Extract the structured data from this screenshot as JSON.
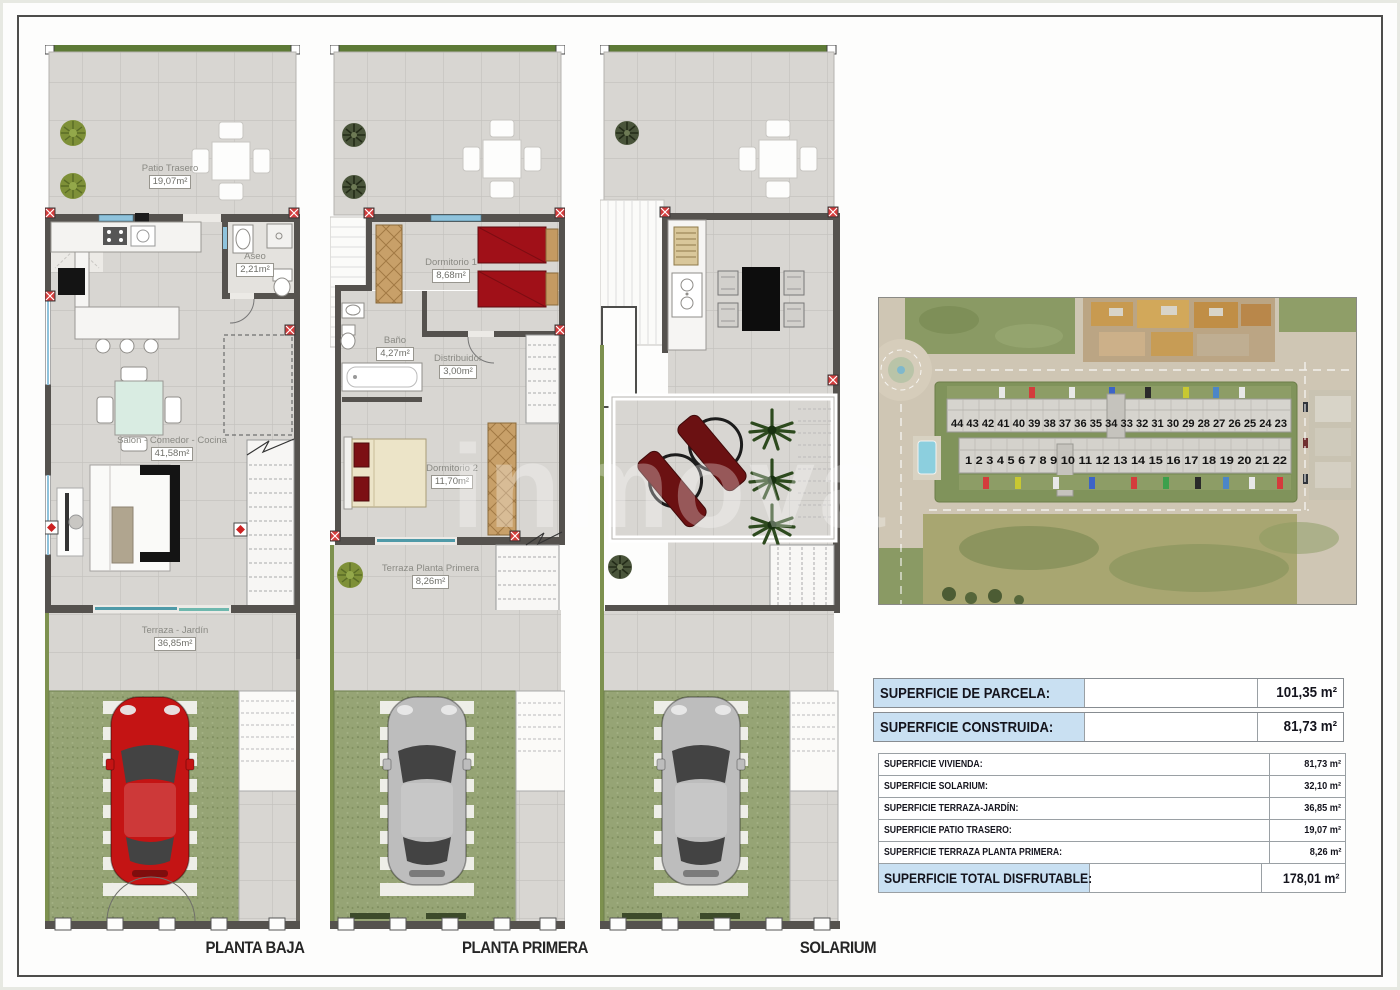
{
  "watermark": "inmova",
  "floors": {
    "planta_baja": {
      "caption": "PLANTA BAJA",
      "rooms": {
        "patio_trasero": {
          "name": "Patio Trasero",
          "area": "19,07m²"
        },
        "aseo": {
          "name": "Aseo",
          "area": "2,21m²"
        },
        "salon": {
          "name": "Salón - Comedor - Cocina",
          "area": "41,58m²"
        },
        "terraza_jardin": {
          "name": "Terraza - Jardín",
          "area": "36,85m²"
        }
      }
    },
    "planta_primera": {
      "caption": "PLANTA PRIMERA",
      "rooms": {
        "dormitorio_1": {
          "name": "Dormitorio 1",
          "area": "8,68m²"
        },
        "bano": {
          "name": "Baño",
          "area": "4,27m²"
        },
        "distribuidor": {
          "name": "Distribuidor",
          "area": "3,00m²"
        },
        "dormitorio_2": {
          "name": "Dormitorio 2",
          "area": "11,70m²"
        },
        "terraza_planta_primera": {
          "name": "Terraza Planta Primera",
          "area": "8,26m²"
        }
      }
    },
    "solarium": {
      "caption": "SOLARIUM"
    }
  },
  "aerial_plot": {
    "back_row_numbers": "44 43 42 41 40 39 38 37 36 35 34 33 32 31 30 29 28 27 26 25 24 23",
    "front_row_numbers": "1 2 3 4 5 6 7 8 9 10 11 12 13 14 15 16 17 18 19 20 21 22"
  },
  "summary": {
    "parcela": {
      "label": "SUPERFICIE DE PARCELA:",
      "value": "101,35 m²"
    },
    "construida": {
      "label": "SUPERFICIE CONSTRUIDA:",
      "value": "81,73 m²"
    },
    "rows": [
      {
        "label": "SUPERFICIE VIVIENDA:",
        "value": "81,73 m²"
      },
      {
        "label": "SUPERFICIE SOLARIUM:",
        "value": "32,10 m²"
      },
      {
        "label": "SUPERFICIE TERRAZA-JARDÍN:",
        "value": "36,85 m²"
      },
      {
        "label": "SUPERFICIE PATIO TRASERO:",
        "value": "19,07 m²"
      },
      {
        "label": "SUPERFICIE TERRAZA PLANTA PRIMERA:",
        "value": "8,26 m²"
      }
    ],
    "total": {
      "label": "SUPERFICIE TOTAL DISFRUTABLE:",
      "value": "178,01 m²"
    }
  },
  "colors": {
    "accent_blue_header": "#c9e0f2",
    "tile_gray": "#d8d6d2",
    "lawn_green": "#96a475",
    "red_car": "#c41414",
    "gray_car": "#bdbdbd",
    "wall_dark": "#55524e",
    "green_strip": "#5d7a36"
  }
}
